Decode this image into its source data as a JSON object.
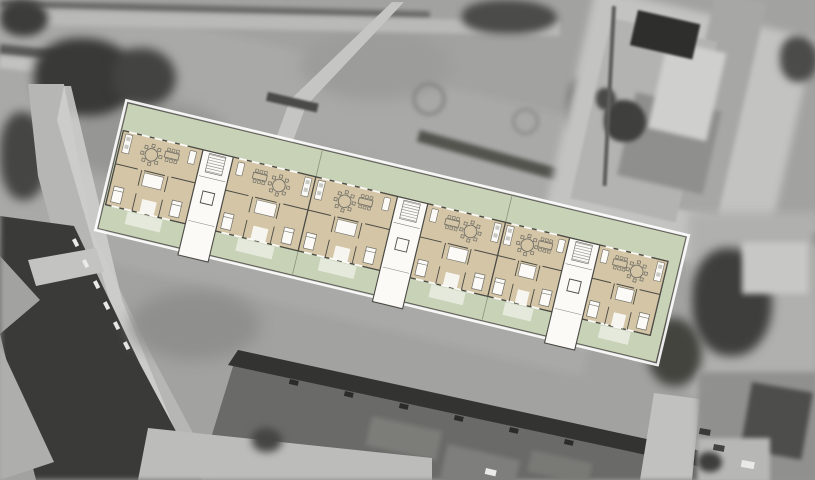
{
  "meta": {
    "canvas_width": 815,
    "canvas_height": 480
  },
  "colors": {
    "photo_base": "#a2a2a0",
    "site_green": "#c8d2b6",
    "floor_beige": "#d3c5a5",
    "room_white": "#fbfaf7",
    "wall_dark": "#4b4a45",
    "line_mid": "#6f6d66",
    "site_border": "#5f5e58",
    "halo_white": "#ffffff",
    "terrace_white": "rgba(255,255,255,0.5)",
    "garden_line": "rgba(100,105,85,0.6)",
    "tread_gray": "#9b9994",
    "appliance_gray": "#c9c9c4"
  },
  "plan": {
    "origin": {
      "x": 128,
      "y": 103
    },
    "rotation_deg": 13.5,
    "site": {
      "width": 574,
      "height": 129
    },
    "band": {
      "x": 2,
      "y": 28,
      "width": 560,
      "height": 76
    },
    "stair_width": 31,
    "stair_depth": 108,
    "stairwells": [
      {
        "x": 84
      },
      {
        "x": 284
      },
      {
        "x": 461
      }
    ],
    "units": [
      {
        "id": "unit-1",
        "x": 2,
        "width": 82,
        "mirror": false
      },
      {
        "id": "unit-2",
        "x": 115,
        "width": 85,
        "mirror": true
      },
      {
        "id": "unit-3",
        "x": 200,
        "width": 84,
        "mirror": false
      },
      {
        "id": "unit-4",
        "x": 315,
        "width": 80,
        "mirror": true
      },
      {
        "id": "unit-5",
        "x": 395,
        "width": 66,
        "mirror": false
      },
      {
        "id": "unit-6",
        "x": 492,
        "width": 70,
        "mirror": true
      }
    ],
    "garden_lines": [
      200,
      395
    ],
    "terrace": {
      "y": 105.5,
      "height": 13
    }
  },
  "aerial_features": [
    {
      "n": "grass-field",
      "t": "rect",
      "x": -40,
      "y": -30,
      "w": 700,
      "h": 250,
      "rot": 13.5,
      "f": "#a9a9a7",
      "b": 4
    },
    {
      "n": "field-dark-patch-1",
      "t": "ell",
      "x": 60,
      "y": 100,
      "w": 170,
      "h": 80,
      "f": "#969694",
      "b": 7
    },
    {
      "n": "field-dark-patch-2",
      "t": "ell",
      "x": 300,
      "y": 30,
      "w": 150,
      "h": 70,
      "f": "#9c9c9a",
      "b": 7
    },
    {
      "n": "field-dark-patch-3",
      "t": "ell",
      "x": 180,
      "y": 150,
      "w": 200,
      "h": 60,
      "f": "#9a9a98",
      "b": 7
    },
    {
      "n": "top-edge-hedge",
      "t": "rect",
      "x": 0,
      "y": 0,
      "w": 430,
      "h": 7,
      "rot": 1.5,
      "f": "#6b6b69",
      "b": 2
    },
    {
      "n": "top-path",
      "t": "rect",
      "x": 0,
      "y": 10,
      "w": 560,
      "h": 14,
      "rot": 1.2,
      "f": "#b9b9b7",
      "b": 2
    },
    {
      "n": "topleft-dark-path",
      "t": "rect",
      "x": 0,
      "y": 44,
      "w": 95,
      "h": 10,
      "rot": 6,
      "f": "#5a5a58",
      "b": 2
    },
    {
      "n": "topleft-light-path",
      "t": "rect",
      "x": 0,
      "y": 56,
      "w": 95,
      "h": 12,
      "rot": 6,
      "f": "#c2c2c0",
      "b": 2
    },
    {
      "n": "footpath-diagonal",
      "t": "poly",
      "p": "392,2 404,2 306,106 268,208 252,204 290,100",
      "f": "#c5c5c3",
      "b": 2
    },
    {
      "n": "hedge-bar",
      "t": "rect",
      "x": 268,
      "y": 92,
      "w": 52,
      "h": 9,
      "rot": 13,
      "f": "#4a4a48",
      "b": 1
    },
    {
      "n": "bush-ring-1",
      "t": "ring",
      "x": 412,
      "y": 82,
      "w": 26,
      "h": 26,
      "bw": 4,
      "f": "#8a8a88",
      "b": 2
    },
    {
      "n": "bush-ring-2",
      "t": "ring",
      "x": 512,
      "y": 108,
      "w": 21,
      "h": 21,
      "bw": 3,
      "f": "#8d8d8b",
      "b": 2
    },
    {
      "n": "trees-topleft-1",
      "t": "blob",
      "x": 0,
      "y": 0,
      "w": 48,
      "h": 36,
      "f": "#3c3c3a",
      "b": 4
    },
    {
      "n": "trees-topleft-2",
      "t": "blob",
      "x": 34,
      "y": 38,
      "w": 104,
      "h": 78,
      "f": "#393937",
      "b": 5
    },
    {
      "n": "trees-topleft-3",
      "t": "blob",
      "x": 112,
      "y": 48,
      "w": 64,
      "h": 58,
      "f": "#434341",
      "b": 5
    },
    {
      "n": "tree-left-road",
      "t": "blob",
      "x": 0,
      "y": 112,
      "w": 48,
      "h": 88,
      "f": "#454543",
      "b": 5
    },
    {
      "n": "tree-field-top",
      "t": "blob",
      "x": 462,
      "y": 0,
      "w": 95,
      "h": 34,
      "f": "#4b4b49",
      "b": 4
    },
    {
      "n": "tree-field-right",
      "t": "blob",
      "x": 568,
      "y": 78,
      "w": 30,
      "h": 66,
      "f": "#4f4f4d",
      "b": 4
    },
    {
      "n": "hedge-line-east",
      "t": "rect",
      "x": 420,
      "y": 130,
      "w": 290,
      "h": 12,
      "rot": 15.5,
      "f": "#54544f",
      "b": 2
    },
    {
      "n": "hedge-line-far-east",
      "t": "rect",
      "x": 598,
      "y": 206,
      "w": 220,
      "h": 13,
      "rot": 7,
      "f": "#4c4c4a",
      "b": 2
    },
    {
      "n": "villa-yard",
      "t": "rect",
      "x": 596,
      "y": -12,
      "w": 225,
      "h": 245,
      "rot": 13,
      "f": "#c3c3c1",
      "b": 4
    },
    {
      "n": "villa-wing-roof",
      "t": "rect",
      "x": 716,
      "y": -8,
      "w": 52,
      "h": 220,
      "rot": 13,
      "f": "#a7a7a5",
      "b": 2
    },
    {
      "n": "villa-roof",
      "t": "rect",
      "x": 612,
      "y": 18,
      "w": 108,
      "h": 185,
      "rot": 13,
      "f": "#b3b3b1",
      "b": 1
    },
    {
      "n": "villa-roof-facet",
      "t": "rect",
      "x": 636,
      "y": 92,
      "w": 88,
      "h": 85,
      "rot": 13,
      "f": "#8f8f8d",
      "b": 2
    },
    {
      "n": "villa-roof-light",
      "t": "rect",
      "x": 668,
      "y": 40,
      "w": 60,
      "h": 90,
      "rot": 13,
      "f": "#cfcfcd",
      "b": 2
    },
    {
      "n": "villa-courtyard-dark",
      "t": "rect",
      "x": 638,
      "y": 10,
      "w": 64,
      "h": 36,
      "rot": 13,
      "f": "#2e2e2c",
      "b": 1
    },
    {
      "n": "villa-tree",
      "t": "blob",
      "x": 604,
      "y": 100,
      "w": 42,
      "h": 42,
      "f": "#3f3f3d",
      "b": 2
    },
    {
      "n": "villa-tree-2",
      "t": "blob",
      "x": 596,
      "y": 88,
      "w": 20,
      "h": 22,
      "f": "#4a4a48",
      "b": 2
    },
    {
      "n": "fence-line",
      "t": "rect",
      "x": 612,
      "y": 6,
      "w": 4,
      "h": 180,
      "rot": 3,
      "f": "#5d5d5b",
      "b": 1
    },
    {
      "n": "right-edge-tree",
      "t": "blob",
      "x": 780,
      "y": 36,
      "w": 38,
      "h": 46,
      "f": "#4b4b49",
      "b": 4
    },
    {
      "n": "right-yard",
      "t": "rect",
      "x": 688,
      "y": 212,
      "w": 130,
      "h": 185,
      "f": "#b0b0ae",
      "b": 5
    },
    {
      "n": "tree-right-1",
      "t": "blob",
      "x": 692,
      "y": 248,
      "w": 80,
      "h": 108,
      "f": "#3e3e3c",
      "b": 5
    },
    {
      "n": "tree-right-2",
      "t": "blob",
      "x": 648,
      "y": 318,
      "w": 54,
      "h": 68,
      "f": "#44443f",
      "b": 5
    },
    {
      "n": "right-path",
      "t": "rect",
      "x": 742,
      "y": 242,
      "w": 66,
      "h": 52,
      "f": "#c7c7c5",
      "b": 3
    },
    {
      "n": "road-west",
      "t": "poly",
      "p": "28,84 64,84 92,232 152,356 218,480 140,480 72,302 38,176",
      "f": "#b6b6b4",
      "b": 2
    },
    {
      "n": "road-west-sidewalk",
      "t": "poly",
      "p": "64,86 71,86 122,300 192,472 181,480 110,302 57,120",
      "f": "#d1d1cf",
      "b": 1,
      "o": 0.85
    },
    {
      "n": "dark-roofs-southwest",
      "t": "poly",
      "p": "0,216 74,226 140,364 202,480 36,480 0,334",
      "f": "#3a3a38",
      "b": 3
    },
    {
      "n": "light-roof-sw-1",
      "t": "poly",
      "p": "0,346 54,462 0,480",
      "f": "#aeaeac",
      "b": 2
    },
    {
      "n": "light-roof-sw-2",
      "t": "poly",
      "p": "0,256 40,300 0,334",
      "f": "#a2a2a0",
      "b": 2
    },
    {
      "n": "roof-crossing-light",
      "t": "poly",
      "p": "28,260 96,248 104,272 36,286",
      "f": "#c3c3c1",
      "b": 2
    },
    {
      "n": "dormer-1",
      "t": "rect",
      "x": 72,
      "y": 240,
      "w": 4,
      "h": 8,
      "rot": -27,
      "f": "#eaeae8",
      "b": 0
    },
    {
      "n": "dormer-2",
      "t": "rect",
      "x": 82,
      "y": 261,
      "w": 4,
      "h": 8,
      "rot": -27,
      "f": "#eaeae8",
      "b": 0
    },
    {
      "n": "dormer-3",
      "t": "rect",
      "x": 93,
      "y": 282,
      "w": 4,
      "h": 8,
      "rot": -27,
      "f": "#eaeae8",
      "b": 0
    },
    {
      "n": "dormer-4",
      "t": "rect",
      "x": 103,
      "y": 303,
      "w": 4,
      "h": 8,
      "rot": -27,
      "f": "#eaeae8",
      "b": 0
    },
    {
      "n": "dormer-5",
      "t": "rect",
      "x": 113,
      "y": 323,
      "w": 4,
      "h": 8,
      "rot": -27,
      "f": "#eaeae8",
      "b": 0
    },
    {
      "n": "dormer-6",
      "t": "rect",
      "x": 123,
      "y": 343,
      "w": 4,
      "h": 8,
      "rot": -27,
      "f": "#eaeae8",
      "b": 0
    },
    {
      "n": "ground-shadow",
      "t": "ell",
      "x": 130,
      "y": 290,
      "w": 130,
      "h": 70,
      "f": "#8f8f8d",
      "b": 8
    },
    {
      "n": "flatroof-building",
      "t": "poly",
      "p": "238,350 706,452 706,480 198,480",
      "f": "#6a6a68",
      "b": 2
    },
    {
      "n": "flatroof-shadow-edge",
      "t": "poly",
      "p": "238,350 706,452 702,467 228,365",
      "f": "#333331",
      "b": 2
    },
    {
      "n": "skylight-1",
      "t": "rect",
      "x": 290,
      "y": 379,
      "w": 9,
      "h": 5,
      "rot": 13,
      "f": "#2b2b29",
      "b": 0
    },
    {
      "n": "skylight-2",
      "t": "rect",
      "x": 345,
      "y": 391,
      "w": 9,
      "h": 5,
      "rot": 13,
      "f": "#2b2b29",
      "b": 0
    },
    {
      "n": "skylight-3",
      "t": "rect",
      "x": 400,
      "y": 403,
      "w": 9,
      "h": 5,
      "rot": 13,
      "f": "#2b2b29",
      "b": 0
    },
    {
      "n": "skylight-4",
      "t": "rect",
      "x": 455,
      "y": 415,
      "w": 9,
      "h": 5,
      "rot": 13,
      "f": "#2b2b29",
      "b": 0
    },
    {
      "n": "skylight-5",
      "t": "rect",
      "x": 510,
      "y": 427,
      "w": 9,
      "h": 5,
      "rot": 13,
      "f": "#2b2b29",
      "b": 0
    },
    {
      "n": "skylight-6",
      "t": "rect",
      "x": 565,
      "y": 439,
      "w": 9,
      "h": 5,
      "rot": 13,
      "f": "#2b2b29",
      "b": 0
    },
    {
      "n": "roof-patch-1",
      "t": "rect",
      "x": 372,
      "y": 416,
      "w": 72,
      "h": 30,
      "rot": 12.5,
      "f": "#81817d",
      "b": 2,
      "o": 0.8
    },
    {
      "n": "roof-patch-2",
      "t": "rect",
      "x": 532,
      "y": 450,
      "w": 62,
      "h": 22,
      "rot": 12.5,
      "f": "#7d7d79",
      "b": 2,
      "o": 0.8
    },
    {
      "n": "road-south",
      "t": "poly",
      "p": "148,428 432,458 432,480 138,480",
      "f": "#bcbcba",
      "b": 2
    },
    {
      "n": "road-southeast",
      "t": "poly",
      "p": "654,393 700,399 692,480 640,480",
      "f": "#c1c1bf",
      "b": 2
    },
    {
      "n": "block-southeast",
      "t": "rect",
      "x": 698,
      "y": 372,
      "w": 120,
      "h": 112,
      "f": "#90908e",
      "b": 3
    },
    {
      "n": "dark-roof-southeast",
      "t": "rect",
      "x": 752,
      "y": 382,
      "w": 62,
      "h": 68,
      "rot": 10,
      "f": "#4d4d4b",
      "b": 2
    },
    {
      "n": "parking-southeast",
      "t": "rect",
      "x": 698,
      "y": 438,
      "w": 72,
      "h": 44,
      "f": "#b7b7b5",
      "b": 2
    },
    {
      "n": "car-white-1",
      "t": "rect",
      "x": 742,
      "y": 460,
      "w": 13,
      "h": 7,
      "rot": 10,
      "f": "#e9e9e7",
      "b": 0
    },
    {
      "n": "car-dark-1",
      "t": "rect",
      "x": 700,
      "y": 428,
      "w": 11,
      "h": 6,
      "rot": 10,
      "f": "#3a3a38",
      "b": 0
    },
    {
      "n": "car-dark-2",
      "t": "rect",
      "x": 714,
      "y": 444,
      "w": 11,
      "h": 6,
      "rot": 10,
      "f": "#434341",
      "b": 0
    },
    {
      "n": "shed-south",
      "t": "rect",
      "x": 448,
      "y": 444,
      "w": 74,
      "h": 36,
      "rot": 13,
      "f": "#7e7e7c",
      "b": 2
    },
    {
      "n": "car-white-2",
      "t": "rect",
      "x": 486,
      "y": 468,
      "w": 11,
      "h": 6,
      "rot": 13,
      "f": "#eaeae8",
      "b": 0
    },
    {
      "n": "tree-south-1",
      "t": "blob",
      "x": 698,
      "y": 452,
      "w": 24,
      "h": 20,
      "f": "#3e3e3c",
      "b": 3
    },
    {
      "n": "tree-south-2",
      "t": "blob",
      "x": 252,
      "y": 428,
      "w": 30,
      "h": 24,
      "f": "#454543",
      "b": 4
    }
  ]
}
